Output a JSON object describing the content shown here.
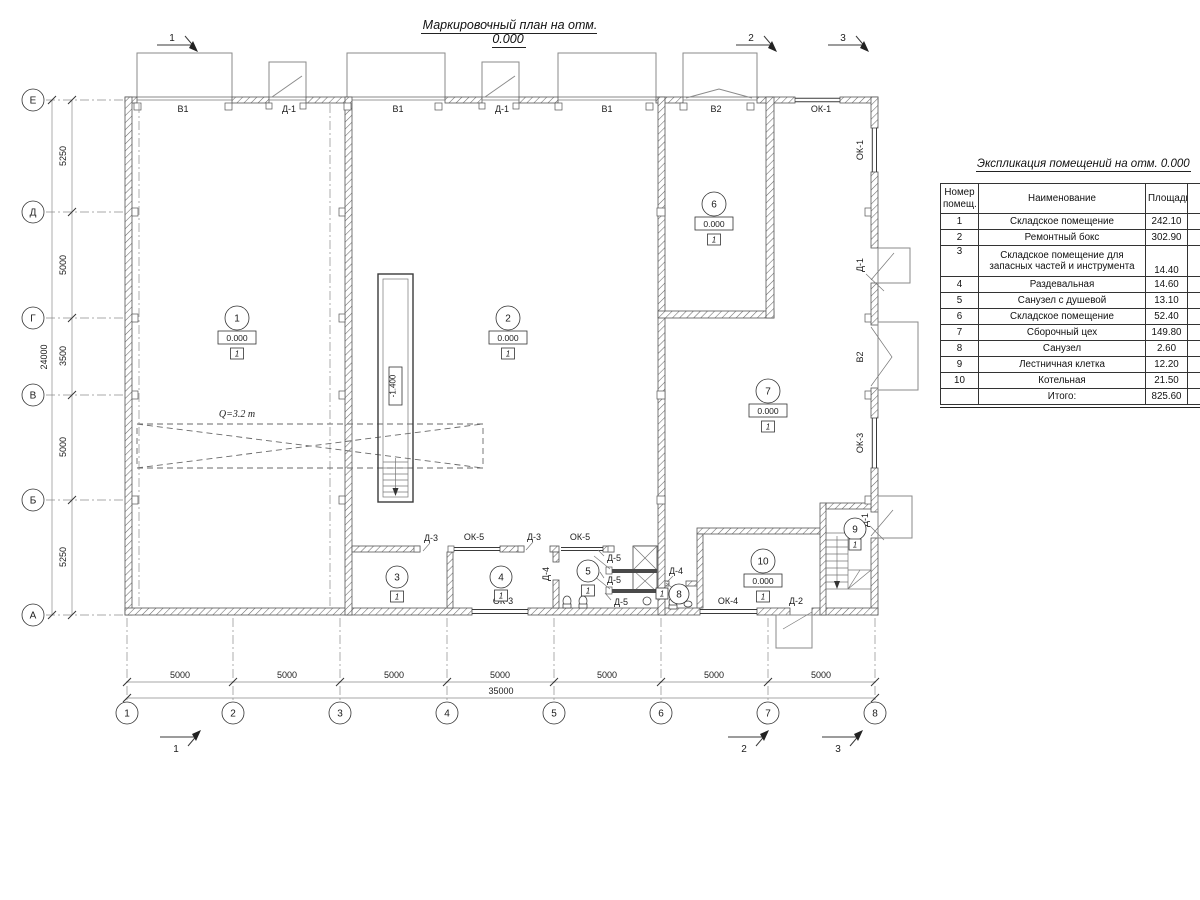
{
  "title": "Маркировочный план на отм. 0.000",
  "explication": {
    "title": "Экспликация помещений на отм. 0.000",
    "col_num": "Номер\nпомещ.",
    "col_name": "Наименование",
    "col_area": "Площадь",
    "col_cut": "Ка\nпо",
    "rows": [
      {
        "num": "1",
        "name": "Складское помещение",
        "area": "242.10"
      },
      {
        "num": "2",
        "name": "Ремонтный бокс",
        "area": "302.90"
      },
      {
        "num": "3",
        "name": "Складское помещение для запасных частей и инструмента",
        "area": "14.40"
      },
      {
        "num": "4",
        "name": "Раздевальная",
        "area": "14.60"
      },
      {
        "num": "5",
        "name": "Санузел с душевой",
        "area": "13.10"
      },
      {
        "num": "6",
        "name": "Складское помещение",
        "area": "52.40"
      },
      {
        "num": "7",
        "name": "Сборочный цех",
        "area": "149.80"
      },
      {
        "num": "8",
        "name": "Санузел",
        "area": "2.60"
      },
      {
        "num": "9",
        "name": "Лестничная клетка",
        "area": "12.20"
      },
      {
        "num": "10",
        "name": "Котельная",
        "area": "21.50"
      }
    ],
    "total_label": "Итого:",
    "total_value": "825.60"
  },
  "axes": {
    "rows": [
      "Е",
      "Д",
      "Г",
      "В",
      "Б",
      "А"
    ],
    "cols": [
      "1",
      "2",
      "3",
      "4",
      "5",
      "6",
      "7",
      "8"
    ]
  },
  "dims": {
    "left": [
      "5250",
      "5000",
      "3500",
      "5000",
      "5250"
    ],
    "left_total": "24000",
    "bottom": [
      "5000",
      "5000",
      "5000",
      "5000",
      "5000",
      "5000",
      "5000"
    ],
    "bottom_total": "35000"
  },
  "sections": {
    "s1": "1",
    "s2": "2",
    "s3": "3"
  },
  "openings": {
    "v1": "В1",
    "v2": "В2",
    "d1": "Д-1",
    "d2": "Д-2",
    "d3": "Д-3",
    "d4": "Д-4",
    "d5": "Д-5",
    "ok1": "ОК-1",
    "ok3": "ОК-3",
    "ok4": "ОК-4",
    "ok5": "ОК-5"
  },
  "rooms": {
    "r1": {
      "num": "1",
      "elev": "0.000",
      "floor": "1"
    },
    "r2": {
      "num": "2",
      "elev": "0.000",
      "floor": "1"
    },
    "r3": {
      "num": "3",
      "floor": "1"
    },
    "r4": {
      "num": "4",
      "floor": "1"
    },
    "r5": {
      "num": "5",
      "floor": "1"
    },
    "r6": {
      "num": "6",
      "elev": "0.000",
      "floor": "1"
    },
    "r7": {
      "num": "7",
      "elev": "0.000",
      "floor": "1"
    },
    "r8": {
      "num": "8",
      "floor": "1"
    },
    "r9": {
      "num": "9",
      "floor": "1"
    },
    "r10": {
      "num": "10",
      "elev": "0.000",
      "floor": "1"
    }
  },
  "annotations": {
    "crane": "Q=3.2 т",
    "pit": "-1.400"
  }
}
